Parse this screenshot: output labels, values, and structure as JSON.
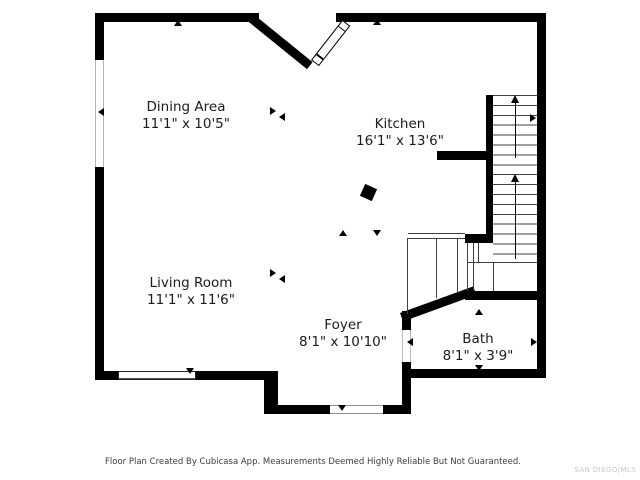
{
  "plan": {
    "rooms": [
      {
        "name": "Dining Area",
        "dimensions": "11'1\" x 10'5\""
      },
      {
        "name": "Kitchen",
        "dimensions": "16'1\" x 13'6\""
      },
      {
        "name": "Living Room",
        "dimensions": "11'1\" x 11'6\""
      },
      {
        "name": "Foyer",
        "dimensions": "8'1\" x 10'10\""
      },
      {
        "name": "Bath",
        "dimensions": "8'1\" x 3'9\""
      }
    ],
    "stairs": {
      "direction": "up"
    }
  },
  "footer": {
    "disclaimer": "Floor Plan Created By Cubicasa App. Measurements Deemed Highly Reliable But Not Guaranteed.",
    "watermark": "SAN DIEGO|MLS"
  },
  "colors": {
    "wall": "#000000",
    "line": "#3f3f3f",
    "label": "#1b1b1b",
    "footer-text": "#3c3c3c",
    "watermark": "#c4c7c9",
    "background": "#ffffff"
  }
}
